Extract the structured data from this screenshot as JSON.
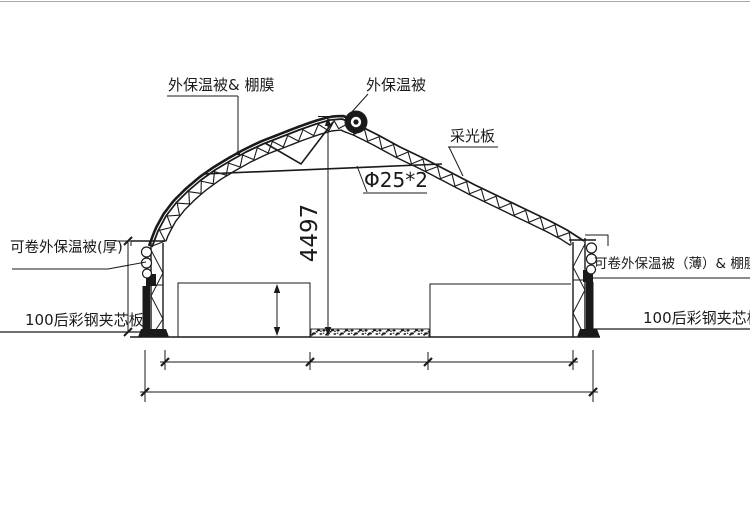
{
  "drawing": {
    "labels": {
      "roof_blanket_film": "外保温被& 棚膜",
      "roof_blanket": "外保温被",
      "daylight_panel": "采光板",
      "tie_rod_spec": "Φ25*2",
      "ridge_height": "4497",
      "left_roll_blanket": "可卷外保温被(厚)",
      "right_roll_blanket": "可卷外保温被（薄）& 棚膜",
      "left_wall_panel": "100后彩钢夹芯板",
      "right_wall_panel": "100后彩钢夹芯板"
    },
    "colors": {
      "line": "#1a1a1a",
      "background": "#ffffff",
      "frame": "#aaaaaa"
    }
  }
}
